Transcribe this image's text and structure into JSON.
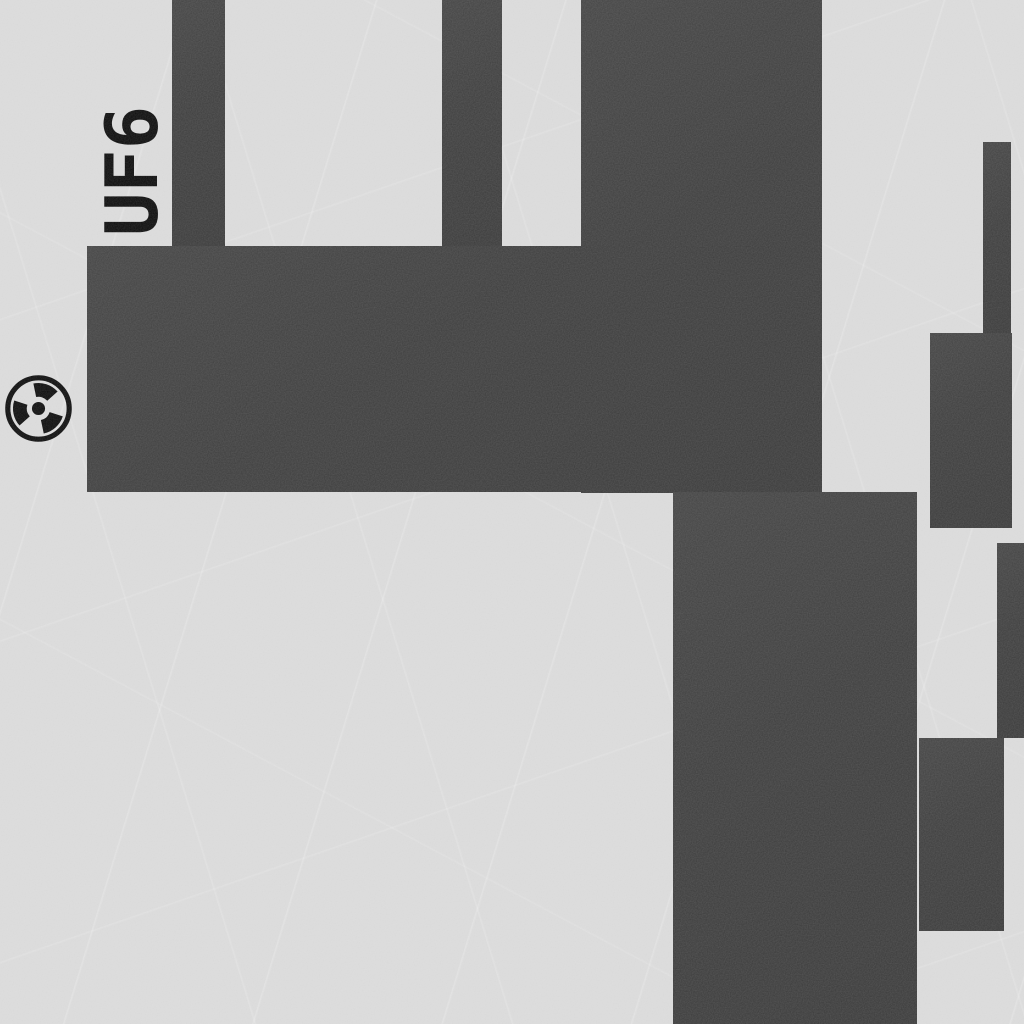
{
  "scene": {
    "label": {
      "text": "UF6"
    },
    "icon": {
      "name": "radiation-icon",
      "glyph": "☢",
      "meaning": "radioactive hazard marker"
    },
    "colors": {
      "background": "#d9d9d9",
      "block": "#3d3d3d",
      "ink": "#0c0c0c"
    }
  }
}
